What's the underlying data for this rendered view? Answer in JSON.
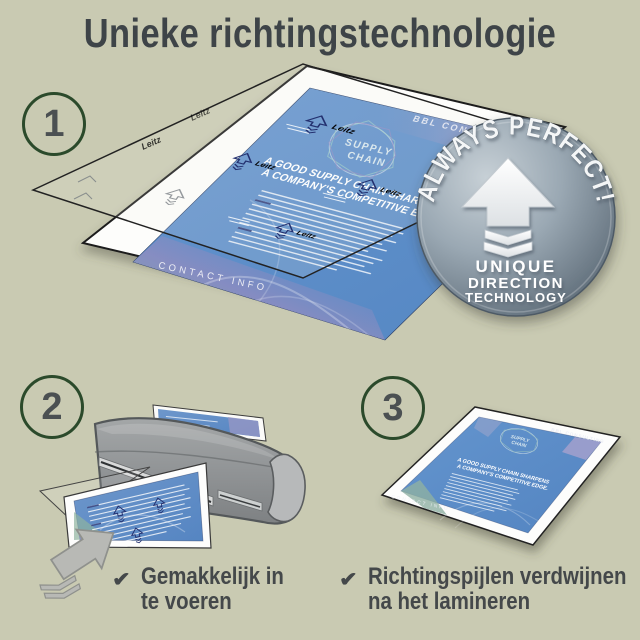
{
  "title": "Unieke richtingstechnologie",
  "steps": [
    {
      "number": "1"
    },
    {
      "number": "2"
    },
    {
      "number": "3"
    }
  ],
  "badge": {
    "arc_text": "ALWAYS PERFECT!",
    "line1": "UNIQUE",
    "line2": "DIRECTION",
    "line3": "TECHNOLOGY"
  },
  "brochure": {
    "brand": "BBL CONSULTING",
    "logo_top": "SUPPLY",
    "logo_bottom": "CHAIN",
    "headline1": "A GOOD SUPPLY CHAIN SHARPENS",
    "headline2": "A COMPANY'S COMPETITIVE EDGE.",
    "footer": "CONTACT INFO"
  },
  "pouch": {
    "watermark": "Leitz"
  },
  "checklist": [
    {
      "mark": "✔",
      "line1": "Gemakkelijk in",
      "line2": "te voeren"
    },
    {
      "mark": "✔",
      "line1": "Richtingspijlen verdwijnen",
      "line2": "na het lamineren"
    }
  ],
  "colors": {
    "background": "#c9cab2",
    "heading_text": "#3e4448",
    "circle_green": "#2b4a2b",
    "brochure_blue": "#5a8dc8",
    "print_navy": "#23306f",
    "badge_gray": "#8795a2",
    "laminator_gray": "#949799"
  }
}
